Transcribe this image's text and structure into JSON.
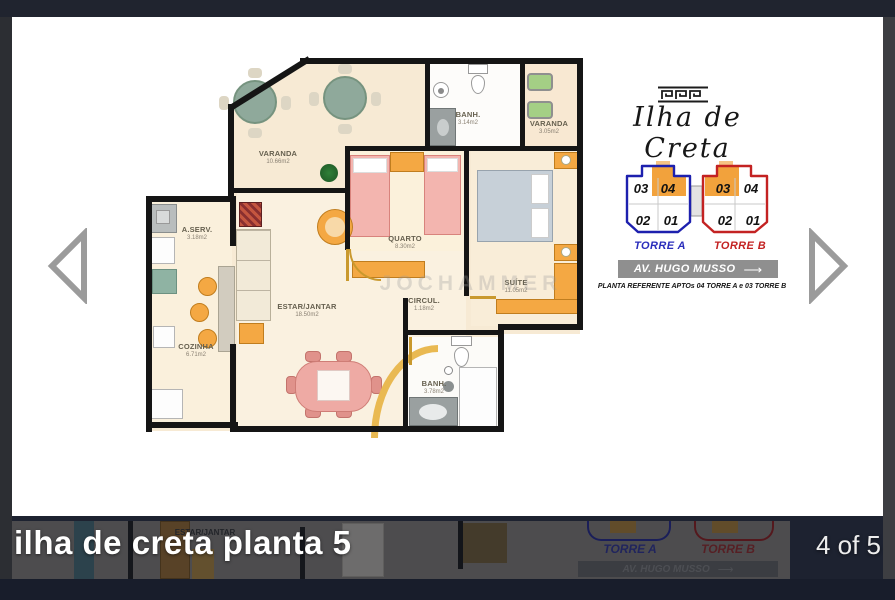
{
  "viewer": {
    "caption": "ilha de creta planta 5",
    "counter": "4 of 5"
  },
  "logo": {
    "title": "Ilha de Creta"
  },
  "floorplan": {
    "watermark": "JOCHAMMER",
    "rooms": [
      {
        "name": "VARANDA",
        "area": "10.66m2"
      },
      {
        "name": "BANH.",
        "area": "3.14m2"
      },
      {
        "name": "VARANDA",
        "area": "3.05m2"
      },
      {
        "name": "QUARTO",
        "area": "8.30m2"
      },
      {
        "name": "SUÍTE",
        "area": "11.05m2"
      },
      {
        "name": "A.SERV.",
        "area": "3.18m2"
      },
      {
        "name": "COZINHA",
        "area": "6.71m2"
      },
      {
        "name": "ESTAR/JANTAR",
        "area": "18.50m2"
      },
      {
        "name": "CIRCUL.",
        "area": "1.18m2"
      },
      {
        "name": "BANH.",
        "area": "3.78m2"
      }
    ]
  },
  "towers": {
    "torre_a_label": "TORRE A",
    "torre_b_label": "TORRE B",
    "torre_a_units": {
      "u03": "03",
      "u04": "04",
      "u02": "02",
      "u01": "01"
    },
    "torre_b_units": {
      "u03": "03",
      "u04": "04",
      "u02": "02",
      "u01": "01"
    },
    "street_sign": "AV. HUGO MUSSO",
    "note": "PLANTA REFERENTE APTOs 04 TORRE A e 03 TORRE B",
    "colors": {
      "torre_a": "#1d20ae",
      "torre_b": "#c32222",
      "highlight": "#f2a23c"
    }
  },
  "preview": {
    "room": "ESTAR/JANTAR",
    "torre_a_label": "TORRE A",
    "torre_b_label": "TORRE B",
    "street_sign": "AV. HUGO MUSSO"
  }
}
